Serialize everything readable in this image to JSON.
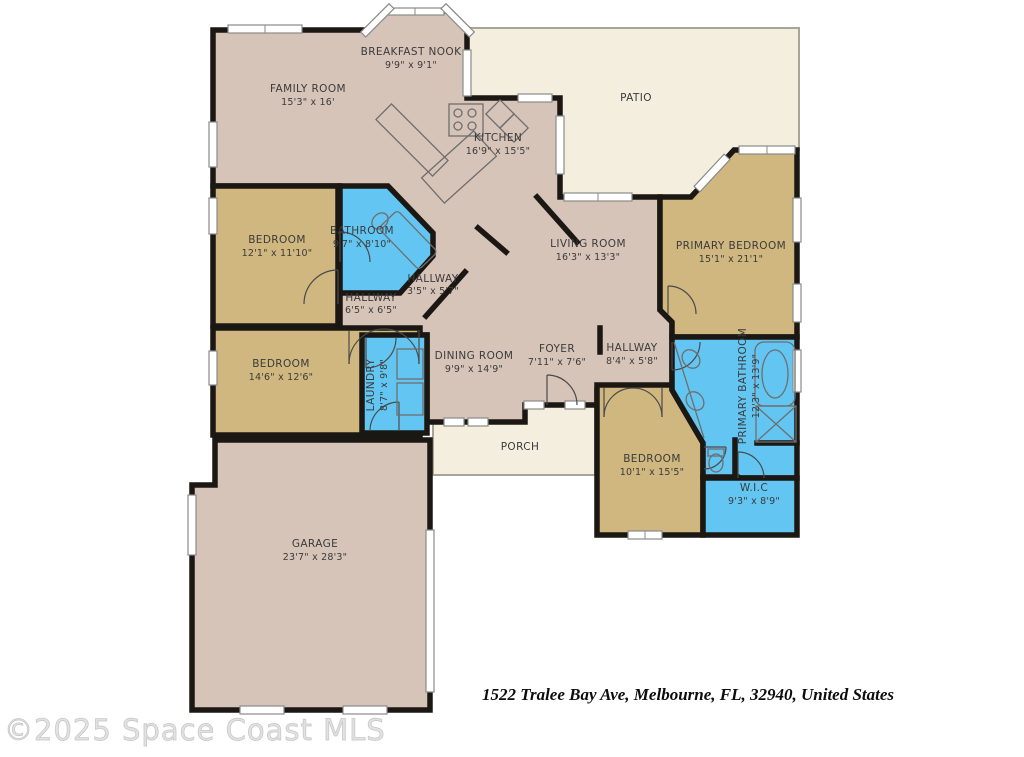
{
  "title": "Floor plan",
  "watermark": "©2025 Space Coast MLS",
  "footer": {
    "address": "1522 Tralee Bay Ave, Melbourne, FL, 32940, United States"
  },
  "colors": {
    "living": "#d7c4b8",
    "bedroom": "#cfb77f",
    "wet": "#63c6f2",
    "outdoor": "#f3eedd",
    "wall": "#1b1713"
  },
  "rooms": {
    "family_room": {
      "name": "FAMILY ROOM",
      "dims": "15'3\" x 16'"
    },
    "breakfast_nook": {
      "name": "BREAKFAST NOOK",
      "dims": "9'9\" x 9'1\""
    },
    "patio": {
      "name": "PATIO",
      "dims": ""
    },
    "kitchen": {
      "name": "KITCHEN",
      "dims": "16'9\" x 15'5\""
    },
    "living_room": {
      "name": "LIVING ROOM",
      "dims": "16'3\" x 13'3\""
    },
    "primary_bedroom": {
      "name": "PRIMARY BEDROOM",
      "dims": "15'1\" x 21'1\""
    },
    "bedroom_front": {
      "name": "BEDROOM",
      "dims": "12'1\" x 11'10\""
    },
    "bathroom": {
      "name": "BATHROOM",
      "dims": "9'7\" x 8'10\""
    },
    "hallway_bath": {
      "name": "HALLWAY",
      "dims": "3'5\" x 5'7\""
    },
    "hallway_bedrooms": {
      "name": "HALLWAY",
      "dims": "6'5\" x 6'5\""
    },
    "bedroom_middle": {
      "name": "BEDROOM",
      "dims": "14'6\" x 12'6\""
    },
    "laundry": {
      "name": "LAUNDRY",
      "dims": "8'7\" x 9'8\""
    },
    "dining_room": {
      "name": "DINING ROOM",
      "dims": "9'9\" x 14'9\""
    },
    "foyer": {
      "name": "FOYER",
      "dims": "7'11\" x 7'6\""
    },
    "hallway_primary": {
      "name": "HALLWAY",
      "dims": "8'4\" x 5'8\""
    },
    "primary_bathroom": {
      "name": "PRIMARY BATHROOM",
      "dims": "12'3\" x 13'9\""
    },
    "bedroom_rear": {
      "name": "BEDROOM",
      "dims": "10'1\" x 15'5\""
    },
    "wic": {
      "name": "W.I.C",
      "dims": "9'3\" x 8'9\""
    },
    "porch": {
      "name": "PORCH",
      "dims": ""
    },
    "garage": {
      "name": "GARAGE",
      "dims": "23'7\" x 28'3\""
    }
  }
}
